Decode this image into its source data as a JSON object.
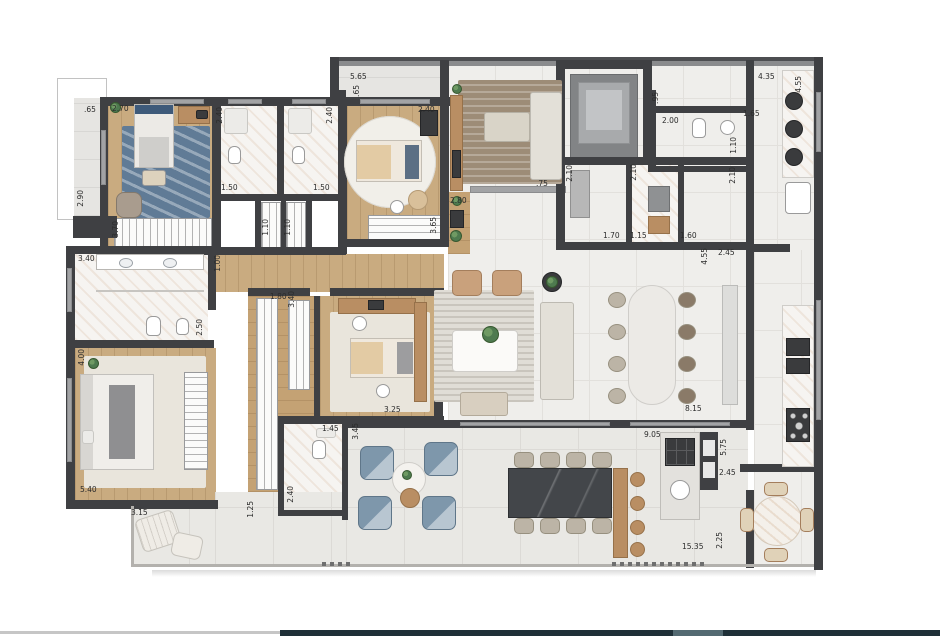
{
  "document": {
    "kind": "apartment floor plan drawing",
    "units": "meters"
  },
  "palette": {
    "wall": "#3f4043",
    "wood_floor": "#c9ab80",
    "tile_floor": "#efeeeb",
    "terrace_tile": "#e9e8e4",
    "marble": "#f6f4f1",
    "blue_rug": "#607b96",
    "blue_chair": "#7e97ab",
    "dark_table": "#43464a",
    "footer_gray": "#c6c6c6",
    "footer_navy": "#1f3038",
    "footer_teal": "#546a72"
  },
  "labels": [
    {
      "text": ".65",
      "x": 84,
      "y": 106,
      "vertical": false
    },
    {
      "text": "2.70",
      "x": 112,
      "y": 105,
      "vertical": false
    },
    {
      "text": "2.40",
      "x": 216,
      "y": 107,
      "vertical": true
    },
    {
      "text": "1.50",
      "x": 221,
      "y": 184,
      "vertical": false
    },
    {
      "text": "2.40",
      "x": 326,
      "y": 107,
      "vertical": true
    },
    {
      "text": "1.50",
      "x": 313,
      "y": 184,
      "vertical": false
    },
    {
      "text": "2.90",
      "x": 77,
      "y": 190,
      "vertical": true
    },
    {
      "text": "3.70",
      "x": 112,
      "y": 221,
      "vertical": true
    },
    {
      "text": "1.10",
      "x": 262,
      "y": 219,
      "vertical": true
    },
    {
      "text": "1.10",
      "x": 284,
      "y": 219,
      "vertical": true
    },
    {
      "text": "5.65",
      "x": 350,
      "y": 73,
      "vertical": false
    },
    {
      "text": ".65",
      "x": 353,
      "y": 85,
      "vertical": true
    },
    {
      "text": "2.40",
      "x": 418,
      "y": 106,
      "vertical": false
    },
    {
      "text": "2.80",
      "x": 450,
      "y": 197,
      "vertical": false
    },
    {
      "text": "3.65",
      "x": 430,
      "y": 217,
      "vertical": true
    },
    {
      "text": ".75",
      "x": 536,
      "y": 180,
      "vertical": false
    },
    {
      "text": "2.10",
      "x": 566,
      "y": 165,
      "vertical": true
    },
    {
      "text": "1.70",
      "x": 603,
      "y": 232,
      "vertical": false
    },
    {
      "text": "2.10",
      "x": 630,
      "y": 164,
      "vertical": true
    },
    {
      "text": "1.15",
      "x": 630,
      "y": 232,
      "vertical": false
    },
    {
      "text": "1.60",
      "x": 680,
      "y": 232,
      "vertical": false
    },
    {
      "text": "2.10",
      "x": 729,
      "y": 167,
      "vertical": true
    },
    {
      "text": "1.10",
      "x": 730,
      "y": 137,
      "vertical": true
    },
    {
      "text": ".95",
      "x": 652,
      "y": 92,
      "vertical": true
    },
    {
      "text": "2.00",
      "x": 662,
      "y": 117,
      "vertical": false
    },
    {
      "text": "1.65",
      "x": 743,
      "y": 110,
      "vertical": false
    },
    {
      "text": "4.35",
      "x": 758,
      "y": 73,
      "vertical": false
    },
    {
      "text": "4.55",
      "x": 795,
      "y": 76,
      "vertical": true
    },
    {
      "text": "4.55",
      "x": 701,
      "y": 248,
      "vertical": true
    },
    {
      "text": "2.45",
      "x": 718,
      "y": 249,
      "vertical": false
    },
    {
      "text": "1.00",
      "x": 214,
      "y": 255,
      "vertical": true
    },
    {
      "text": "3.40",
      "x": 78,
      "y": 255,
      "vertical": false
    },
    {
      "text": "2.50",
      "x": 196,
      "y": 319,
      "vertical": true
    },
    {
      "text": "1.80",
      "x": 270,
      "y": 293,
      "vertical": false
    },
    {
      "text": "3.40",
      "x": 288,
      "y": 291,
      "vertical": true
    },
    {
      "text": "4.00",
      "x": 78,
      "y": 349,
      "vertical": true
    },
    {
      "text": "5.40",
      "x": 80,
      "y": 486,
      "vertical": false
    },
    {
      "text": "3.15",
      "x": 131,
      "y": 509,
      "vertical": false
    },
    {
      "text": "1.25",
      "x": 247,
      "y": 501,
      "vertical": true
    },
    {
      "text": "1.45",
      "x": 322,
      "y": 425,
      "vertical": false
    },
    {
      "text": "2.40",
      "x": 287,
      "y": 486,
      "vertical": true
    },
    {
      "text": "3.25",
      "x": 384,
      "y": 406,
      "vertical": false
    },
    {
      "text": "3.45",
      "x": 352,
      "y": 423,
      "vertical": true
    },
    {
      "text": "8.15",
      "x": 685,
      "y": 405,
      "vertical": false
    },
    {
      "text": "9.05",
      "x": 644,
      "y": 431,
      "vertical": false
    },
    {
      "text": "5.75",
      "x": 720,
      "y": 439,
      "vertical": true
    },
    {
      "text": "2.45",
      "x": 719,
      "y": 469,
      "vertical": false
    },
    {
      "text": "15.35",
      "x": 682,
      "y": 543,
      "vertical": false
    },
    {
      "text": "2.25",
      "x": 716,
      "y": 532,
      "vertical": true
    }
  ]
}
